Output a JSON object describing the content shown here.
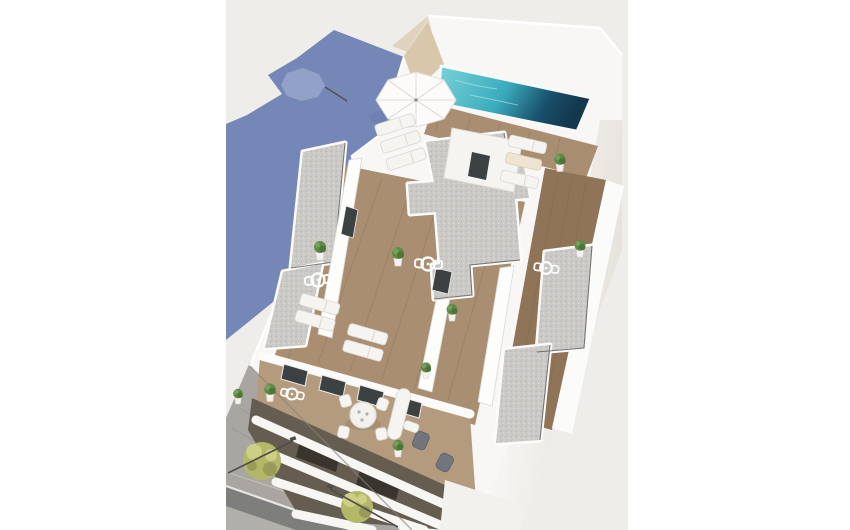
{
  "scene": {
    "type": "3d-architectural-render",
    "view": "aerial top-down perspective",
    "description": "Aerial 3D render of a modern white apartment building: rooftop swimming pool with dark deep end, white parasol, sun loungers, wooden deck terraces separated by white walls, gravel roof sections, potted plants, penthouse terrace with round dining table and chairs, stacked white balcony slabs on the lower facade, street below with trees and lamp posts, and a long blue building shadow with a parasol silhouette cast to the left.",
    "elements": [
      "rooftop swimming pool",
      "white parasol",
      "sun loungers",
      "wooden deck terraces",
      "gravel roof sections",
      "white divider walls",
      "stair bulkhead",
      "potted plants",
      "bistro tables with chairs",
      "round dining table with four chairs",
      "gray lounge chairs",
      "glass terrace doors",
      "balcony slab facade",
      "sidewalk with trees",
      "street lamps",
      "asphalt road",
      "building cast shadow with umbrella silhouette"
    ],
    "counts": {
      "trees": 2,
      "street_lamps": 2,
      "gravel_roofs": 5,
      "parasols_visible": 1,
      "dining_chairs": 4
    }
  },
  "palette": {
    "canvas": "#ffffff",
    "photoBg": "#efedea",
    "shadowBlue": "#7487b7",
    "shadowLight": "#97a6cb",
    "wallWhite": "#f8f7f5",
    "wallShade": "#e7e3dc",
    "wallDeep": "#d9d4cc",
    "beige": "#d9c7ac",
    "poolLight": "#7bd3d7",
    "poolMid": "#3aabbe",
    "poolDeep": "#19506b",
    "poolDark": "#14394e",
    "wood": "#a98e71",
    "woodDark": "#8f7458",
    "woodWarm": "#b49b7e",
    "gravel": "#cbcac7",
    "gravelDotDark": "#b4b3b0",
    "gravelDotLight": "#dddcd9",
    "parapet": "#fbfbfa",
    "shadowLine": "#55524d",
    "glass": "#3c4244",
    "plant": "#5f8a47",
    "plantDark": "#4d7539",
    "pot": "#f3f2ef",
    "lounger": "#f5f4f1",
    "loungerEdge": "#dcd8d1",
    "cushion": "#efe4d2",
    "chairGray": "#72767c",
    "asphalt": "#7e7e7c",
    "sidewalk": "#a9a6a1",
    "sidewalkLine": "#93908a",
    "curb": "#e8e6e2",
    "tree": "#b5b768",
    "treeLight": "#cdcf84",
    "treeDark": "#999b58",
    "lamp": "#4e4d4b",
    "facadeGap": "#665d51",
    "facadeDark": "#39342e"
  }
}
